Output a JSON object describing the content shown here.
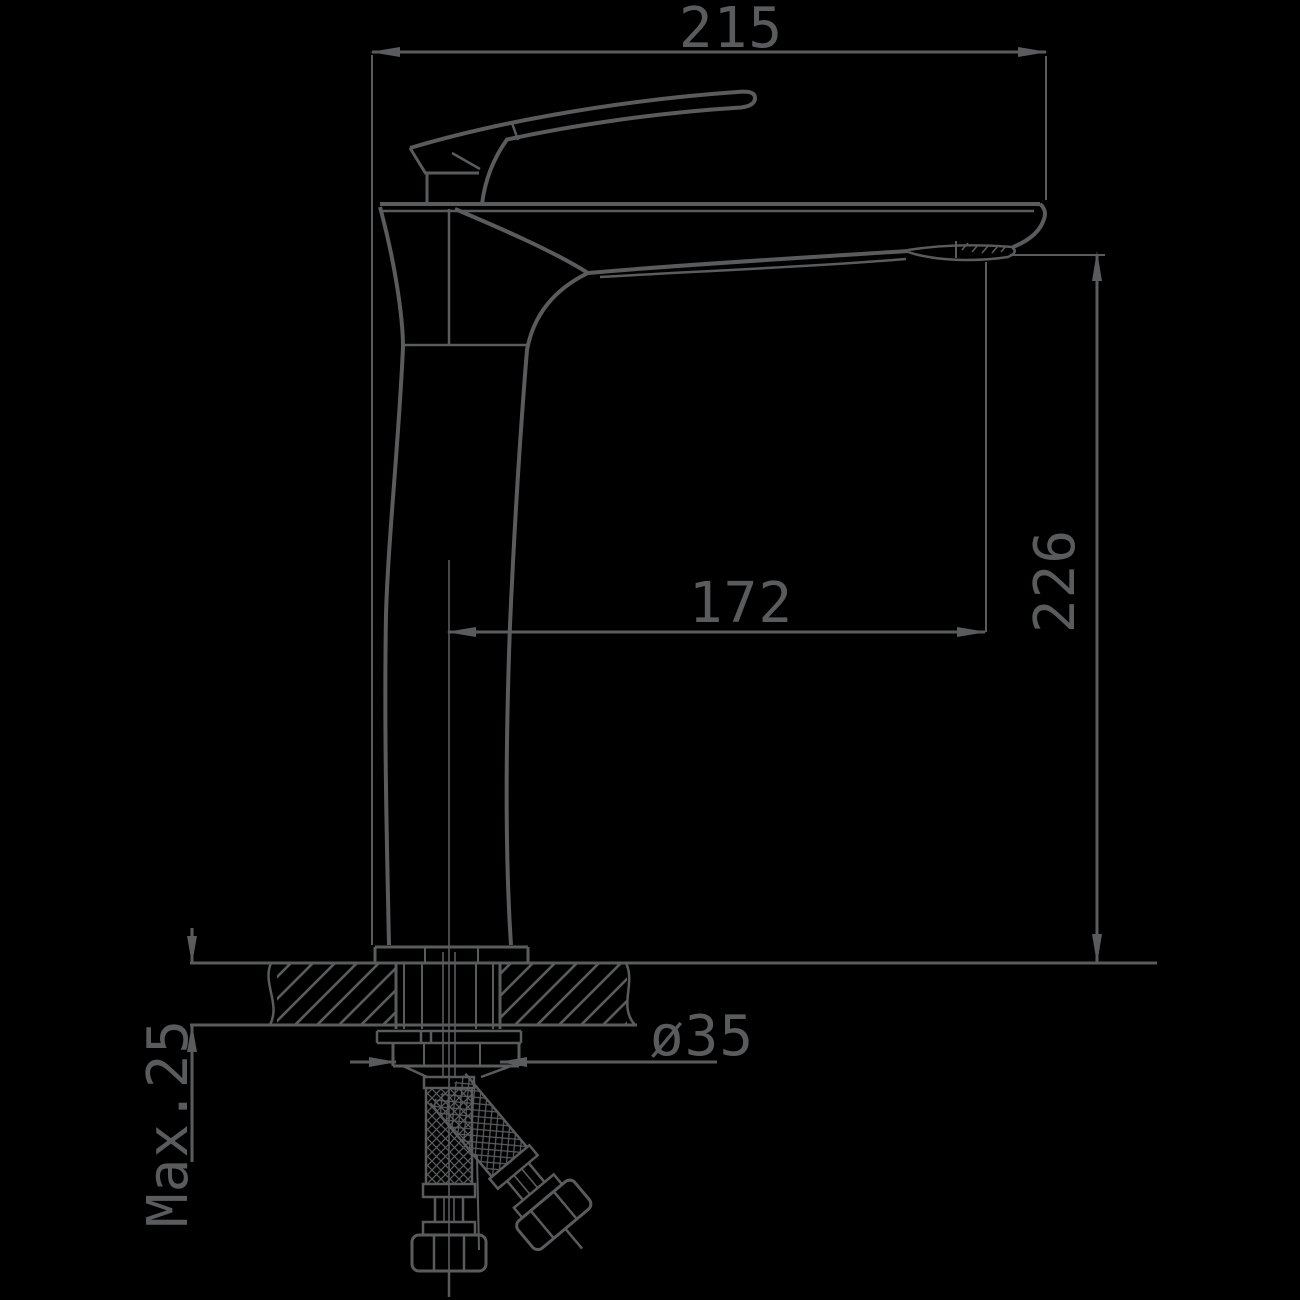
{
  "drawing": {
    "title": "Basin mixer faucet — side elevation installation drawing",
    "background_color": "#000000",
    "line_color": "#5a5b5d",
    "dimensions": {
      "overall_width": {
        "label": "215"
      },
      "spout_height": {
        "label": "226"
      },
      "spout_reach": {
        "label": "172"
      },
      "mounting_diameter": {
        "label": "ø35"
      },
      "deck_thickness": {
        "label": "Max.25"
      }
    }
  }
}
